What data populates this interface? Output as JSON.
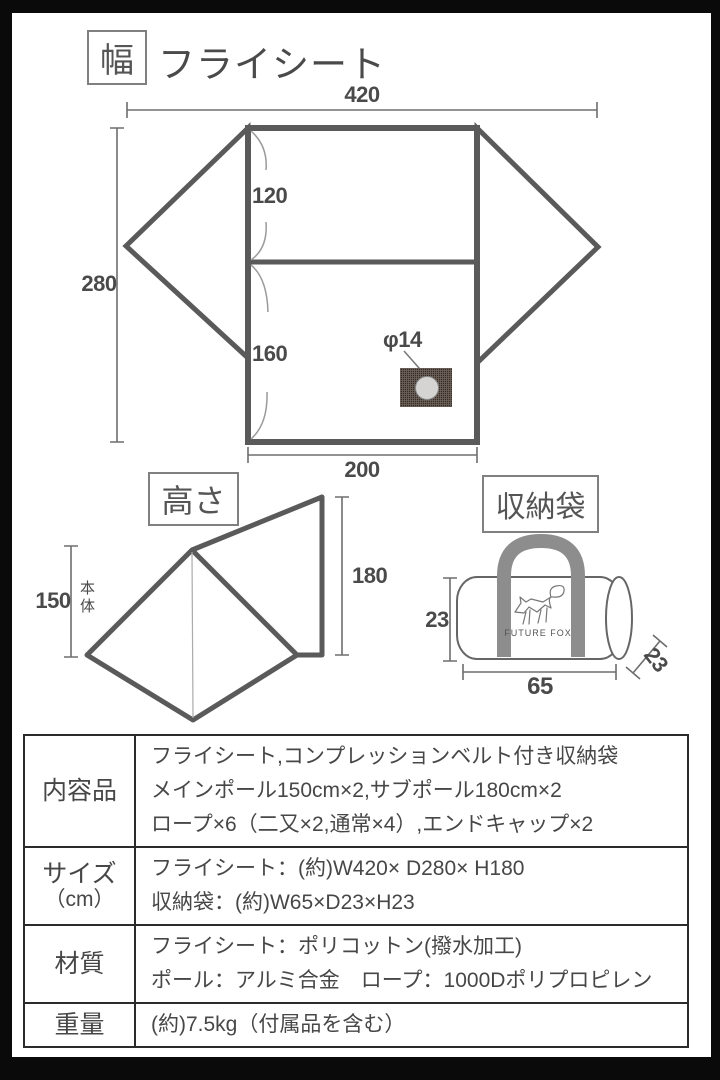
{
  "width_section": {
    "tag": "幅",
    "title": "フライシート",
    "dim_top": "420",
    "dim_left": "280",
    "dim_upper": "120",
    "dim_lower": "160",
    "dim_bottom": "200",
    "vent_label": "φ14"
  },
  "height_section": {
    "tag": "高さ",
    "dim_right": "180",
    "dim_left": "150",
    "dim_left_note": "本体"
  },
  "bag_section": {
    "tag": "収納袋",
    "brand": "FUTURE FOX",
    "dim_height": "23",
    "dim_width": "65",
    "dim_depth": "23"
  },
  "spec_table": {
    "rows": [
      {
        "label": "内容品",
        "label2": "",
        "lines": [
          "フライシート,コンプレッションベルト付き収納袋",
          "メインポール150cm×2,サブポール180cm×2",
          "ロープ×6（二又×2,通常×4）,エンドキャップ×2"
        ]
      },
      {
        "label": "サイズ",
        "label2": "（cm）",
        "lines": [
          "フライシート：(約)W420× D280× H180",
          "収納袋：(約)W65×D23×H23"
        ]
      },
      {
        "label": "材質",
        "label2": "",
        "lines": [
          "フライシート：ポリコットン(撥水加工)",
          "ポール：アルミ合金　ロープ：1000Dポリプロピレン"
        ]
      },
      {
        "label": "重量",
        "label2": "",
        "lines": [
          "(約)7.5kg（付属品を含む）"
        ]
      }
    ]
  },
  "colors": {
    "outline": "#5a5a5a",
    "dimension": "#6e6e6e",
    "handle": "#8d8d8d",
    "frame": "#0a0a0a"
  }
}
